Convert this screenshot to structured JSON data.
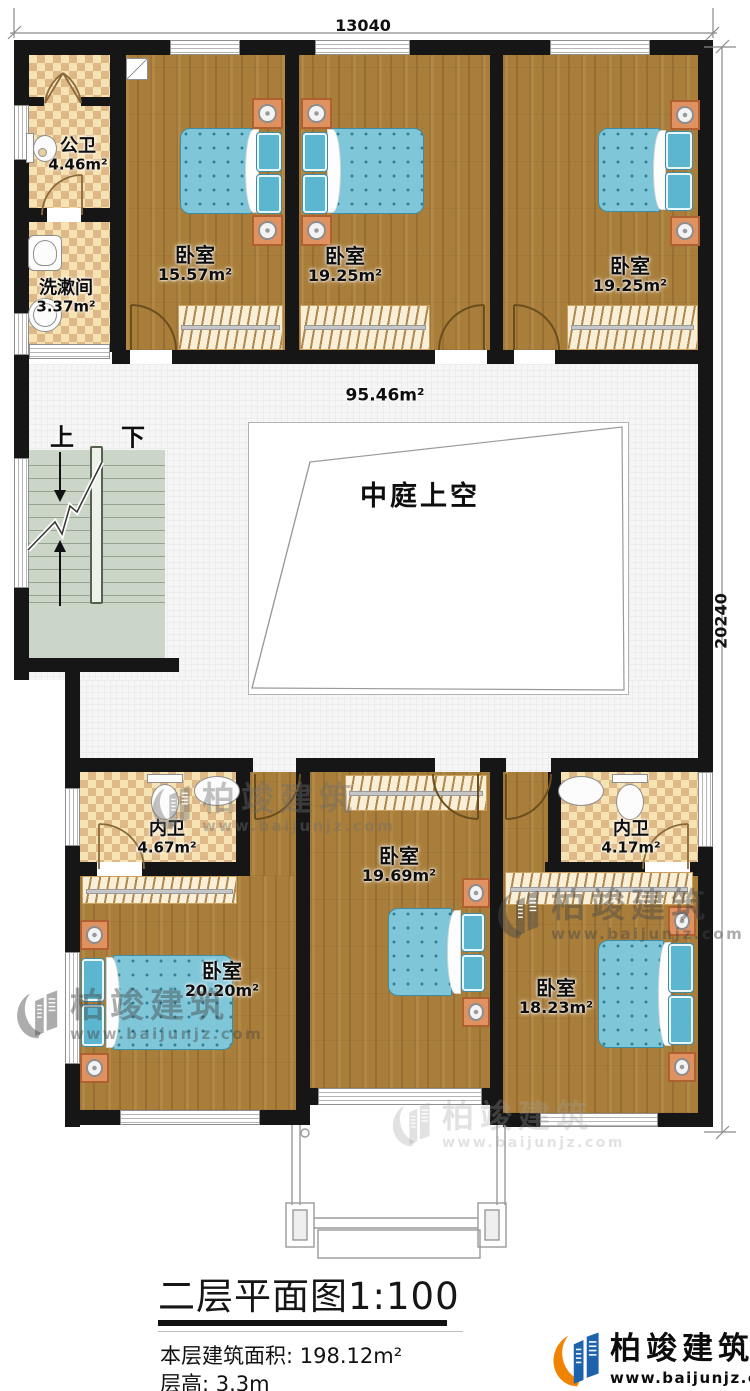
{
  "dimensions": {
    "top": "13040",
    "right": "20240"
  },
  "hall": {
    "area": "95.46m²"
  },
  "atrium": {
    "label": "中庭上空"
  },
  "stairs": {
    "up": "上",
    "down": "下"
  },
  "rooms": {
    "public_bath": {
      "name": "公卫",
      "area": "4.46m²"
    },
    "washroom": {
      "name": "洗漱间",
      "area": "3.37m²"
    },
    "bedroom_nw": {
      "name": "卧室",
      "area": "15.57m²"
    },
    "bedroom_n": {
      "name": "卧室",
      "area": "19.25m²"
    },
    "bedroom_ne": {
      "name": "卧室",
      "area": "19.25m²"
    },
    "bath_sw": {
      "name": "内卫",
      "area": "4.67m²"
    },
    "bedroom_s": {
      "name": "卧室",
      "area": "19.69m²"
    },
    "bath_se": {
      "name": "内卫",
      "area": "4.17m²"
    },
    "bedroom_sw": {
      "name": "卧室",
      "area": "20.20m²"
    },
    "bedroom_se": {
      "name": "卧室",
      "area": "18.23m²"
    }
  },
  "title": {
    "text": "二层平面图",
    "scale": "1:100"
  },
  "info": {
    "area_label": "本层建筑面积:",
    "area_value": "198.12m²",
    "height_label": "层高:",
    "height_value": "3.3m"
  },
  "brand": {
    "name": "柏竣建筑",
    "url": "www.baijunjz.com"
  },
  "watermark": {
    "name": "柏竣建筑",
    "url": "www.baijunjz.com"
  },
  "colors": {
    "wall": "#161616",
    "wood": "#a97e3b",
    "tile": "#f6e3b4",
    "bed": "#7fc6d9",
    "brand_blue": "#1e62ac",
    "brand_orange": "#f08300"
  }
}
